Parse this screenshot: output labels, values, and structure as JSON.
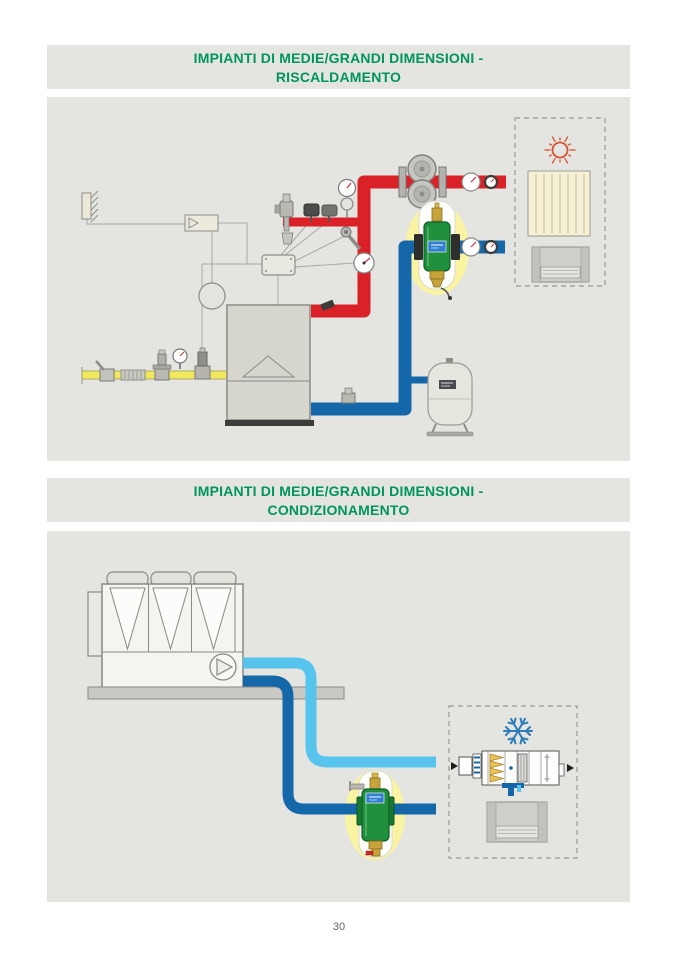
{
  "page": {
    "number": "30"
  },
  "colors": {
    "title_green": "#00955f",
    "panel_background": "#e4e4e1",
    "hot_water_pipe": "#da2128",
    "return_water_pipe": "#1467a8",
    "chilled_supply_pipe": "#56c4ec",
    "gas_pipe_yellow": "#f0e95e",
    "product_highlight_halo": "#faf3a2",
    "separator_body_green": "#21903c",
    "sun_symbol_orange": "#d9532e",
    "snowflake_blue": "#2d7cb8"
  },
  "sections": {
    "heating": {
      "title_line1": "IMPIANTI DI MEDIE/GRANDI DIMENSIONI -",
      "title_line2": "RISCALDAMENTO"
    },
    "cooling": {
      "title_line1": "IMPIANTI DI MEDIE/GRANDI DIMENSIONI -",
      "title_line2": "CONDIZIONAMENTO"
    }
  },
  "diagrams": {
    "heating": {
      "components": [
        "outdoor-temperature-sensor",
        "climatic-regulator",
        "wiring-junction-box",
        "boiler",
        "gas-line",
        "gas-ball-valve",
        "gas-flex-connector",
        "gas-pressure-regulator",
        "gas-pressure-gauge",
        "gas-solenoid-valve",
        "safety-relief-valve",
        "pressure-switches",
        "pressure-gauge-with-siphon",
        "immersion-probe",
        "thermometer",
        "twin-circulator-pump",
        "flow-pipe-hot",
        "return-pipe",
        "magnetic-dirt-separator",
        "expansion-vessel",
        "drain-valve",
        "emitters-zone",
        "sun-icon",
        "radiator",
        "fan-coil"
      ]
    },
    "cooling": {
      "components": [
        "air-cooled-chiller",
        "chiller-fans",
        "chiller-pump-icon",
        "chilled-supply-pipe",
        "chilled-return-pipe",
        "magnetic-dirt-separator",
        "cooling-zone",
        "snowflake-icon",
        "air-handling-unit",
        "fan-coil"
      ]
    }
  }
}
